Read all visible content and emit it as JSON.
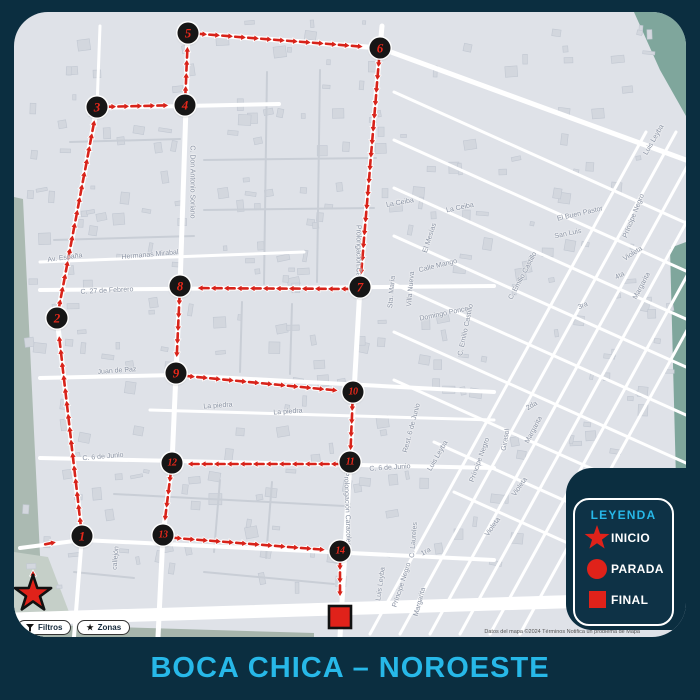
{
  "title": "BOCA CHICA – NOROESTE",
  "colors": {
    "background_navy": "#0b2e40",
    "accent_cyan": "#27b8e8",
    "route_red": "#d8231a",
    "marker_black": "#161616",
    "map_gray": "#dfe2e8"
  },
  "legend": {
    "title": "LEYENDA",
    "items": [
      {
        "icon": "star",
        "label": "INICIO"
      },
      {
        "icon": "circle",
        "label": "PARADA"
      },
      {
        "icon": "square",
        "label": "FINAL"
      }
    ]
  },
  "map": {
    "attribution": "Datos del mapa ©2024   Términos   Notifica un problema de Mapa",
    "buttons": [
      {
        "icon": "filter-icon",
        "label": "Filtros"
      },
      {
        "icon": "star-icon",
        "label": "Zonas"
      }
    ],
    "start": {
      "x": 19,
      "y": 582,
      "label": "INICIO"
    },
    "end": {
      "x": 326,
      "y": 605,
      "label": "FINAL"
    },
    "stops": [
      {
        "n": 1,
        "x": 68,
        "y": 524
      },
      {
        "n": 2,
        "x": 43,
        "y": 306
      },
      {
        "n": 3,
        "x": 83,
        "y": 95
      },
      {
        "n": 4,
        "x": 171,
        "y": 93
      },
      {
        "n": 5,
        "x": 174,
        "y": 21
      },
      {
        "n": 6,
        "x": 366,
        "y": 36
      },
      {
        "n": 7,
        "x": 346,
        "y": 275
      },
      {
        "n": 8,
        "x": 166,
        "y": 274
      },
      {
        "n": 9,
        "x": 162,
        "y": 361
      },
      {
        "n": 10,
        "x": 339,
        "y": 380
      },
      {
        "n": 11,
        "x": 336,
        "y": 450
      },
      {
        "n": 12,
        "x": 158,
        "y": 451
      },
      {
        "n": 13,
        "x": 149,
        "y": 523
      },
      {
        "n": 14,
        "x": 326,
        "y": 539
      }
    ],
    "route_segments": [
      [
        19,
        578,
        19,
        540
      ],
      [
        23,
        534,
        57,
        527
      ],
      [
        68,
        524,
        43,
        306
      ],
      [
        43,
        306,
        83,
        95
      ],
      [
        83,
        95,
        171,
        93
      ],
      [
        171,
        93,
        174,
        21
      ],
      [
        174,
        21,
        366,
        36
      ],
      [
        366,
        36,
        346,
        275
      ],
      [
        346,
        277,
        166,
        276
      ],
      [
        166,
        274,
        162,
        361
      ],
      [
        162,
        363,
        339,
        380
      ],
      [
        339,
        380,
        336,
        450
      ],
      [
        336,
        452,
        158,
        452
      ],
      [
        158,
        451,
        149,
        523
      ],
      [
        149,
        525,
        326,
        539
      ],
      [
        326,
        539,
        326,
        598
      ]
    ],
    "street_labels": [
      {
        "t": "C. Don Antonio Soriano",
        "x": 178,
        "y": 170,
        "r": 90
      },
      {
        "t": "Av. España",
        "x": 51,
        "y": 246,
        "r": -8
      },
      {
        "t": "Hermanas Mirabal",
        "x": 136,
        "y": 243,
        "r": -5
      },
      {
        "t": "C. 27 de Febrero",
        "x": 93,
        "y": 279,
        "r": -3
      },
      {
        "t": "La Ceiba",
        "x": 386,
        "y": 191,
        "r": -10
      },
      {
        "t": "La Ceiba",
        "x": 446,
        "y": 196,
        "r": -12
      },
      {
        "t": "El Mesías",
        "x": 416,
        "y": 226,
        "r": -72
      },
      {
        "t": "Calle Mango",
        "x": 424,
        "y": 254,
        "r": -14
      },
      {
        "t": "Sta. María",
        "x": 378,
        "y": 280,
        "r": -85
      },
      {
        "t": "Villa Nueva",
        "x": 397,
        "y": 277,
        "r": -85
      },
      {
        "t": "Domingo Ponce",
        "x": 430,
        "y": 302,
        "r": -12
      },
      {
        "t": "Prolongación Caracoles",
        "x": 344,
        "y": 250,
        "r": 90
      },
      {
        "t": "Prolongación Caracoles",
        "x": 333,
        "y": 497,
        "r": 88
      },
      {
        "t": "El Buen Pastor",
        "x": 566,
        "y": 202,
        "r": -13
      },
      {
        "t": "San Luis",
        "x": 554,
        "y": 222,
        "r": -12
      },
      {
        "t": "Luis Leyba",
        "x": 640,
        "y": 128,
        "r": -60
      },
      {
        "t": "Príncipe Negro",
        "x": 620,
        "y": 204,
        "r": -68
      },
      {
        "t": "Violeta",
        "x": 619,
        "y": 242,
        "r": -32
      },
      {
        "t": "4ta",
        "x": 606,
        "y": 264,
        "r": -28
      },
      {
        "t": "Margarita",
        "x": 628,
        "y": 274,
        "r": -62
      },
      {
        "t": "3ra",
        "x": 569,
        "y": 294,
        "r": -24
      },
      {
        "t": "C. Emilio Castillo",
        "x": 509,
        "y": 264,
        "r": -62
      },
      {
        "t": "C. Emilio Castillo",
        "x": 452,
        "y": 318,
        "r": -78
      },
      {
        "t": "Juan de Paz",
        "x": 103,
        "y": 359,
        "r": -4
      },
      {
        "t": "La piedra",
        "x": 204,
        "y": 394,
        "r": -4
      },
      {
        "t": "La piedra",
        "x": 274,
        "y": 400,
        "r": -4
      },
      {
        "t": "C. 6 de Junio",
        "x": 89,
        "y": 445,
        "r": -5
      },
      {
        "t": "C. 6 de Junio",
        "x": 376,
        "y": 456,
        "r": -4
      },
      {
        "t": "Rest. 6 de Junio",
        "x": 398,
        "y": 416,
        "r": -75
      },
      {
        "t": "Luis Leyba",
        "x": 424,
        "y": 444,
        "r": -60
      },
      {
        "t": "Príncipe Negro",
        "x": 466,
        "y": 448,
        "r": -70
      },
      {
        "t": "Girasol",
        "x": 492,
        "y": 428,
        "r": -80
      },
      {
        "t": "Margarita",
        "x": 520,
        "y": 418,
        "r": -62
      },
      {
        "t": "2da",
        "x": 518,
        "y": 394,
        "r": -30
      },
      {
        "t": "Violeta",
        "x": 506,
        "y": 475,
        "r": -55
      },
      {
        "t": "Violeta",
        "x": 479,
        "y": 515,
        "r": -55
      },
      {
        "t": "C. Laureles",
        "x": 400,
        "y": 528,
        "r": -85
      },
      {
        "t": "1ra",
        "x": 412,
        "y": 540,
        "r": -28
      },
      {
        "t": "Príncipe Negro",
        "x": 388,
        "y": 573,
        "r": -72
      },
      {
        "t": "Margarita",
        "x": 406,
        "y": 590,
        "r": -75
      },
      {
        "t": "Luis Leyba",
        "x": 367,
        "y": 572,
        "r": -82
      },
      {
        "t": "callejón",
        "x": 102,
        "y": 546,
        "r": -85
      }
    ]
  }
}
